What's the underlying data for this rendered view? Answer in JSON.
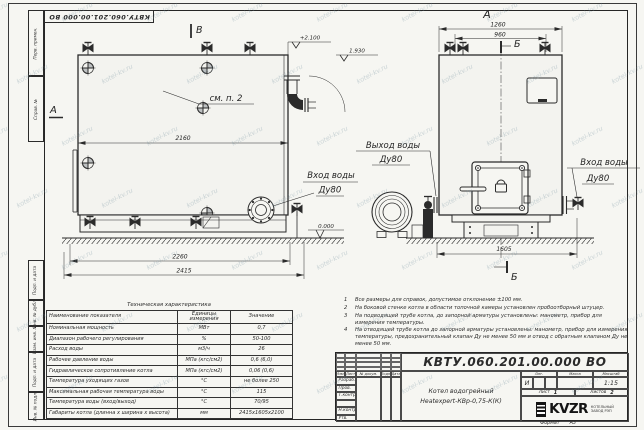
{
  "page": {
    "watermark": "kotel-kv.ru",
    "top_stamp": "КВТУ.060.201.00.000  ВО",
    "format_label": "Формат",
    "format_value": "А3"
  },
  "colors": {
    "ink": "#2b2b2b",
    "paper": "#f6f6f2",
    "watermark": "#6e8c9b"
  },
  "frame": {
    "columns_top": [
      "Перв. примен.",
      "Справ. №"
    ],
    "columns_bottom": [
      "Подп. и дата",
      "Инв. № дубл.",
      "Взам. инв. №",
      "Подп. и дата",
      "Инв. № подл."
    ]
  },
  "drawing": {
    "front_view": {
      "section_b_label": "В",
      "view_a_label": "А",
      "see_note": "см. п. 2",
      "dim_body_width": "2160",
      "dim_base_width": "2260",
      "dim_overall_width": "2415",
      "elev_top": "+2.100",
      "elev_pipe": "1.930",
      "elev_ground": "0.000",
      "inlet_line1": "Вход воды",
      "inlet_line2": "Ду80"
    },
    "side_view": {
      "view_label": "А",
      "section_label_top": "Б",
      "section_label_bottom": "Б",
      "dim_overall": "1260",
      "dim_valves": "960",
      "dim_depth": "1605",
      "outlet_line1": "Выход воды",
      "outlet_line2": "Ду80",
      "inlet_line1": "Вход воды",
      "inlet_line2": "Ду80"
    }
  },
  "tech_table": {
    "title": "Техническая характеристика",
    "headers": [
      "Наименование показателя",
      "Единицы измерения",
      "Значение"
    ],
    "rows": [
      [
        "Номинальная мощность",
        "МВт",
        "0,7"
      ],
      [
        "Диапазон рабочего регулирования",
        "%",
        "50-100"
      ],
      [
        "Расход воды",
        "м3/ч",
        "26"
      ],
      [
        "Рабочее давление воды",
        "МПа (кгс/см2)",
        "0,6 (6,0)"
      ],
      [
        "Гидравлическое сопротивление котла",
        "МПа (кгс/см2)",
        "0,06 (0,6)"
      ],
      [
        "Температура уходящих газов",
        "°С",
        "не более 250"
      ],
      [
        "Максимальная рабочая температура воды",
        "°С",
        "115"
      ],
      [
        "Температура воды (вход/выход)",
        "°С",
        "70/95"
      ],
      [
        "Габариты котла (длинна х ширина х высота)",
        "мм",
        "2415х1605х2100"
      ]
    ]
  },
  "notes": {
    "items": [
      {
        "num": "1",
        "text": "Все размеры для справок, допустимое отклонение ±100 мм."
      },
      {
        "num": "2",
        "text": "На боковой стенке котла в области топочной камеры установлен пробоотборный штуцер."
      },
      {
        "num": "3",
        "text": "На подводящей трубе котла, до запорной арматуры установлены: манометр, прибор для измерения температуры."
      },
      {
        "num": "4",
        "text": "На отводящей трубе котла до запорной арматуры установлены: манометр, прибор для измерения температуры, предохранительный клапан Ду не менее 50 мм и отвод с обратным клапаном Ду не менее 50 мм."
      }
    ]
  },
  "title_block": {
    "doc_number": "КВТУ.060.201.00.000  ВО",
    "name_line1": "Котел водогрейный",
    "name_line2": "Heatexpert-КВр-0,75-К(К)",
    "sig_header": [
      "Изм.",
      "Лист",
      "№ докум.",
      "Подп.",
      "Дата"
    ],
    "sig_rows": [
      "Разраб.",
      "Пров.",
      "Т.контр.",
      "",
      "Н.контр.",
      "Утв."
    ],
    "lit_label": "Лит.",
    "lit_value": "И",
    "mass_label": "Масса",
    "scale_label": "Масштаб",
    "scale_value": "1:15",
    "sheet_label": "Лист",
    "sheet_value": "1",
    "sheets_label": "Листов",
    "sheets_value": "2",
    "logo_text": "KVZR",
    "company_line1": "КОТЕЛЬНЫЙ",
    "company_line2": "ЗАВОД РЭП"
  }
}
